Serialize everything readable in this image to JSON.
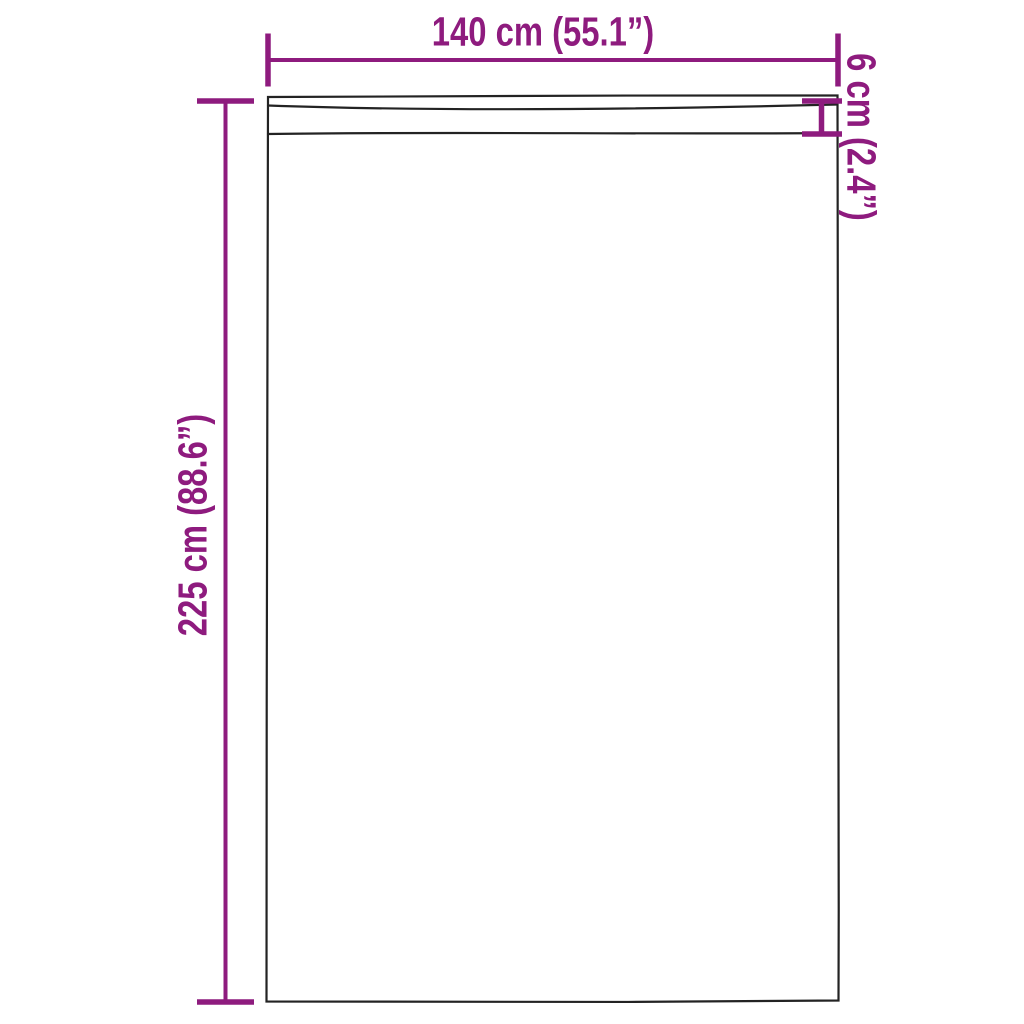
{
  "diagram": {
    "title": "Curtain panel dimension diagram",
    "product": "curtain-panel-with-rod-pocket",
    "colors": {
      "dimension_annotation": "#8e1b7e",
      "product_outline": "#232323",
      "background": "#ffffff"
    },
    "dimensions": {
      "width": {
        "label": "140 cm (55.1”)",
        "value_cm": 140,
        "value_in": 55.1
      },
      "height": {
        "label": "225 cm (88.6”)",
        "value_cm": 225,
        "value_in": 88.6
      },
      "header_height": {
        "label": "6 cm (2.4”)",
        "value_cm": 6,
        "value_in": 2.4
      }
    }
  }
}
